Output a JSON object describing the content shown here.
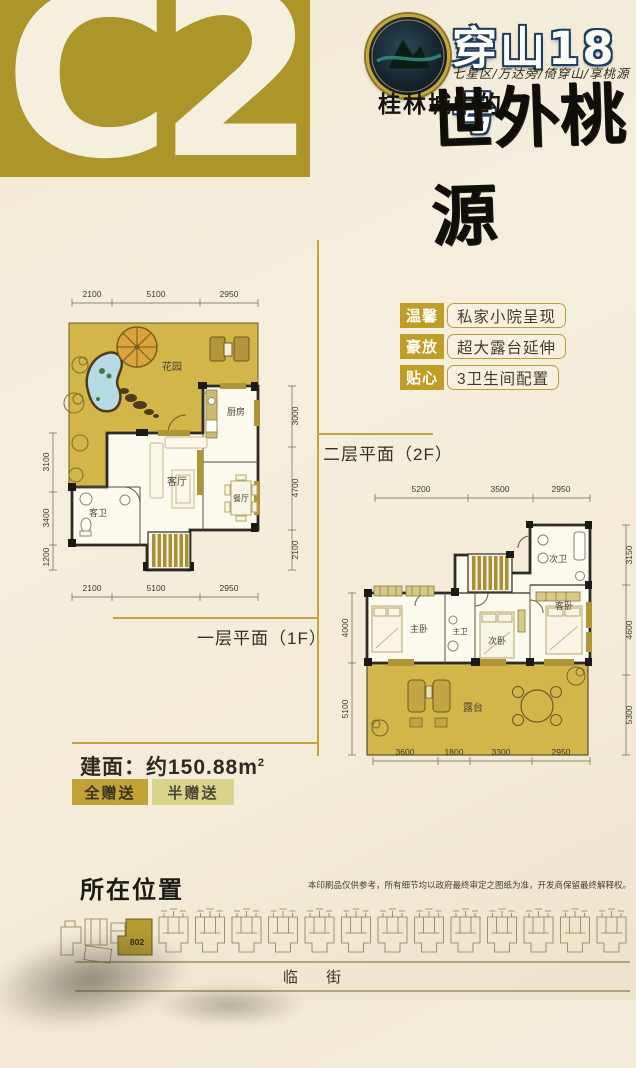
{
  "unit_badge": {
    "label": "C2"
  },
  "header": {
    "brand": "穿山18号",
    "subtitle": "七星区/万达旁/倚穿山/享桃源",
    "tagline_prefix": "桂林城中的",
    "tagline_calligraphy": "世外桃源"
  },
  "features": [
    {
      "tag": "温馨",
      "text": "私家小院呈现"
    },
    {
      "tag": "豪放",
      "text": "超大露台延伸"
    },
    {
      "tag": "贴心",
      "text": "3卫生间配置"
    }
  ],
  "plan2": {
    "title": "二层平面（2F）",
    "dims_top": [
      "5200",
      "3500",
      "2950"
    ],
    "dims_bottom": [
      "3600",
      "1800",
      "3300",
      "2950"
    ],
    "dims_left": [
      "4000",
      "5100"
    ],
    "dims_right": [
      "3150",
      "4600",
      "5300"
    ],
    "rooms": {
      "second_bath": "次卫",
      "master_bed": "主卧",
      "master_bath": "主卫",
      "second_bed": "次卧",
      "guest_bed": "客卧",
      "terrace": "露台"
    }
  },
  "plan1": {
    "title": "一层平面（1F）",
    "dims_top": [
      "2100",
      "5100",
      "2950"
    ],
    "dims_bottom": [
      "2100",
      "5100",
      "2950"
    ],
    "dims_left": [
      "3100",
      "3400",
      "1200"
    ],
    "dims_right": [
      "3000",
      "4700",
      "2100"
    ],
    "rooms": {
      "garden": "花园",
      "kitchen": "厨房",
      "living": "客厅",
      "dining": "餐厅",
      "guest_bath": "客卫"
    }
  },
  "area": {
    "label": "建面：约150.88m",
    "sup": "2"
  },
  "legend": [
    {
      "label": "全赠送",
      "color": "#c2a136"
    },
    {
      "label": "半赠送",
      "color": "#d8d48b"
    }
  ],
  "location": {
    "title": "所在位置",
    "unit_code": "802",
    "street_label": "临 街",
    "disclaimer": "本印刷品仅供参考，所有细节均以政府最终审定之图纸为准，开发商保留最终解释权。"
  },
  "colors": {
    "gold_block": "#ac9529",
    "accent_gold": "#c3a43c",
    "garden_fill": "#d2b64a",
    "wall": "#2e2b24",
    "pond": "#b7dbe3"
  }
}
